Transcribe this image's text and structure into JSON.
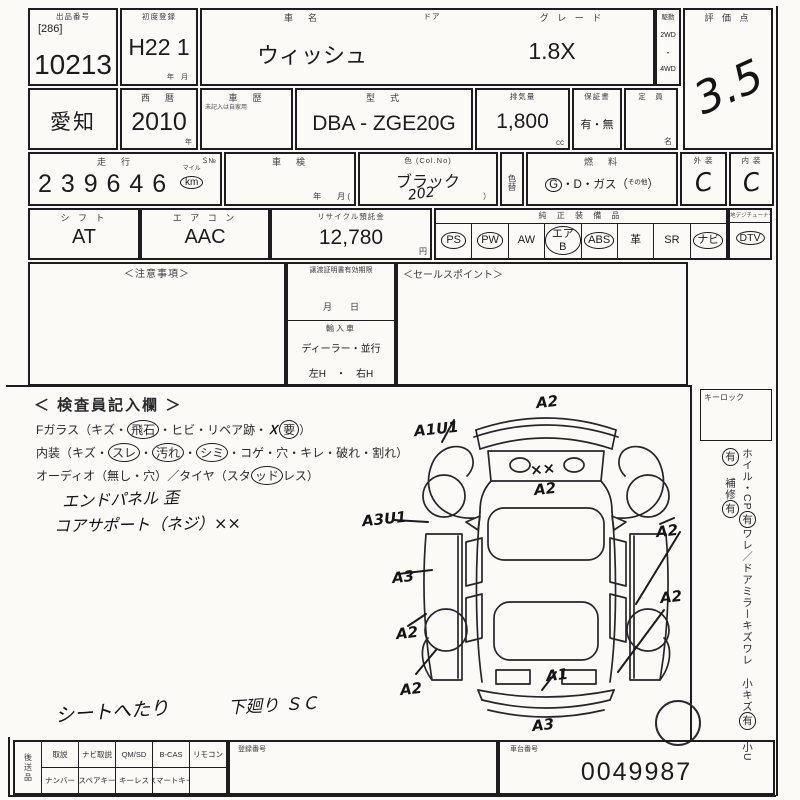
{
  "row1": {
    "lot": {
      "label": "出品番号",
      "bracket": "[286]",
      "number": "10213"
    },
    "first_reg": {
      "label": "初度登録",
      "value": "H22 1",
      "units": "年　月"
    },
    "name": {
      "label": "車　名",
      "value": "ウィッシュ"
    },
    "door": {
      "label": "ドア"
    },
    "grade": {
      "label": "グ レ ー ド",
      "value": "1.8X"
    },
    "drive": {
      "label": "駆動",
      "opt1": "2WD",
      "dot": "・",
      "opt2": "4WD"
    },
    "score": {
      "label": "評 価 点",
      "value": "3.5"
    }
  },
  "row2": {
    "region": {
      "value": "愛知"
    },
    "year": {
      "label": "西　暦",
      "value": "2010",
      "unit": "年"
    },
    "history": {
      "label": "車　歴",
      "note": "未記入は自家用"
    },
    "model": {
      "label": "型　式",
      "value": "DBA - ZGE20G"
    },
    "displacement": {
      "label": "排気量",
      "value": "1,800",
      "unit": "cc"
    },
    "warranty": {
      "label": "保証書",
      "value": "有・無"
    },
    "capacity": {
      "label": "定　員",
      "unit": "名"
    }
  },
  "row3": {
    "mileage": {
      "label": "走　行",
      "star": "Ｓ№",
      "value": "2 3 9  6 4 6",
      "unit_top": "マイル",
      "unit": "km"
    },
    "inspection": {
      "label": "車　検",
      "units": "年　　月 ("
    },
    "color": {
      "label": "色 (Col.No)",
      "value": "ブラック",
      "code": "202",
      "close": "）"
    },
    "color_change": {
      "label": "色替"
    },
    "fuel": {
      "label": "燃　料",
      "g": "G",
      "rest": "・D・ガス（",
      "other": "その他",
      "close": "）"
    },
    "exterior": {
      "label": "外 装",
      "value": "C"
    },
    "interior": {
      "label": "内 装",
      "value": "C"
    }
  },
  "row4": {
    "shift": {
      "label": "シ フ ト",
      "value": "AT"
    },
    "aircon": {
      "label": "エ ア コ ン",
      "value": "AAC"
    },
    "recycle": {
      "label": "リサイクル預託金",
      "value": "12,780",
      "unit": "円"
    },
    "equipment": {
      "label": "純 正 装 備 品",
      "items": [
        {
          "label": "PS",
          "circled": true
        },
        {
          "label": "PW",
          "circled": true
        },
        {
          "label": "AW",
          "circled": false
        },
        {
          "label": "エアB",
          "circled": true
        },
        {
          "label": "ABS",
          "circled": true
        },
        {
          "label": "革",
          "circled": false
        },
        {
          "label": "SR",
          "circled": false
        },
        {
          "label": "ナビ",
          "circled": true
        }
      ]
    },
    "dtv": {
      "label": "地デジチューナー有",
      "value": "DTV",
      "circled": true
    }
  },
  "row5": {
    "notes": {
      "label": "＜注意事項＞"
    },
    "transfer": {
      "label": "譲渡証明書有効期限",
      "date_units": "月　　日",
      "import_label": "輸入車",
      "import_type": "ディーラー・並行",
      "handle": "左H　・　右H"
    },
    "sales": {
      "label": "＜セールスポイント＞"
    }
  },
  "inspector": {
    "title": "＜ 検査員記入欄 ＞",
    "line1": [
      {
        "t": "Fガラス（キズ・"
      },
      {
        "t": "飛石",
        "circled": true
      },
      {
        "t": "・ヒビ・リペア跡・ "
      },
      {
        "t": "Ｘ",
        "hand": true
      },
      {
        "t": "要",
        "circled": true
      },
      {
        "t": "）"
      }
    ],
    "line2": [
      {
        "t": "内装（キズ・"
      },
      {
        "t": "スレ",
        "circled": true
      },
      {
        "t": "・"
      },
      {
        "t": "汚れ",
        "circled": true
      },
      {
        "t": "・"
      },
      {
        "t": "シミ",
        "circled": true
      },
      {
        "t": "・コゲ・穴・キレ・破れ・割れ）"
      }
    ],
    "line3": [
      {
        "t": "オーディオ（無し・穴）／タイヤ（スタ"
      },
      {
        "t": "ッド",
        "circled": true
      },
      {
        "t": "レス）"
      }
    ],
    "hand1": "エンドパネル 歪",
    "hand2": "コアサポート（ネジ）××",
    "hand3": "シートへたり",
    "hand4": "下廻り ＳＣ"
  },
  "diagram": {
    "markers": [
      {
        "label": "A2",
        "x": 536,
        "y": 393
      },
      {
        "label": "A1U1",
        "x": 414,
        "y": 420
      },
      {
        "label": "××",
        "x": 530,
        "y": 460
      },
      {
        "label": "A2",
        "x": 534,
        "y": 480
      },
      {
        "label": "A3U1",
        "x": 362,
        "y": 510
      },
      {
        "label": "A2",
        "x": 656,
        "y": 522
      },
      {
        "label": "A3",
        "x": 392,
        "y": 568
      },
      {
        "label": "A2",
        "x": 396,
        "y": 624
      },
      {
        "label": "A2",
        "x": 400,
        "y": 680
      },
      {
        "label": "A1",
        "x": 546,
        "y": 666
      },
      {
        "label": "A2",
        "x": 660,
        "y": 588
      },
      {
        "label": "A3",
        "x": 532,
        "y": 716
      }
    ]
  },
  "right_col": {
    "keylock": "キーロック",
    "notes": [
      {
        "t": "ホイル・CP"
      },
      {
        "t": "有",
        "circled": true
      },
      {
        "t": "ワレ／ドアミラーキズワレ　"
      },
      {
        "t": "小キズ"
      },
      {
        "t": "有",
        "circled": true
      },
      {
        "t": "　小U"
      },
      {
        "t": "有",
        "circled": true
      },
      {
        "t": "　補修"
      },
      {
        "t": "有",
        "circled": true
      }
    ]
  },
  "bottom": {
    "left_label": "後送品",
    "row1": [
      "取説",
      "ナビ取説",
      "QM/SD",
      "B-CAS",
      "リモコン"
    ],
    "row2": [
      "ナンバー",
      "スペアキー",
      "キーレス",
      "スマートキー",
      ""
    ],
    "registration": {
      "label": "登録番号"
    },
    "chassis": {
      "label": "車台番号",
      "value": "0049987"
    }
  }
}
